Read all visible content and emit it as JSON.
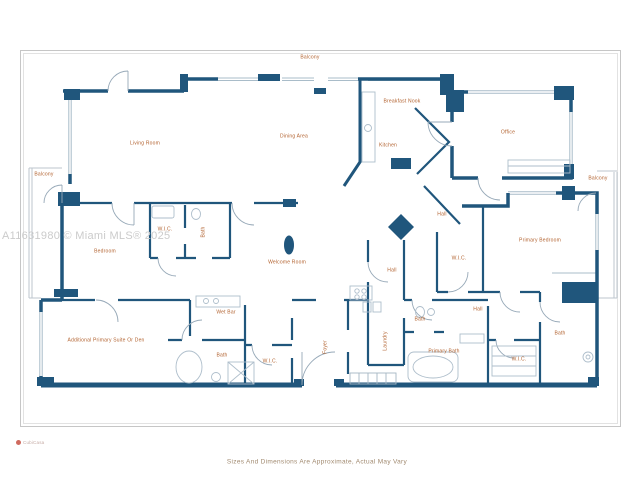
{
  "floor_plan": {
    "rooms": {
      "balcony_top": "Balcony",
      "balcony_left": "Balcony",
      "balcony_right": "Balcony",
      "living_room": "Living Room",
      "dining_area": "Dining Area",
      "breakfast_nook": "Breakfast Nook",
      "kitchen": "Kitchen",
      "office": "Office",
      "hall_upper": "Hall",
      "hall_lower": "Hall",
      "hall_entry": "Hall",
      "bedroom": "Bedroom",
      "wic_bedroom": "W.I.C.",
      "bath_bedroom": "Bath",
      "welcome_room": "Welcome Room",
      "primary_bedroom": "Primary Bedroom",
      "wic_primary": "W.I.C.",
      "additional_primary_suite": "Additional Primary Suite Or Den",
      "wet_bar": "Wet Bar",
      "bath_center": "Bath",
      "wic_center": "W.I.C.",
      "foyer": "Foyer",
      "laundry": "Laundry",
      "bath_small": "Bath",
      "primary_bath": "Primary Bath",
      "wic_right": "W.I.C.",
      "bath_right": "Bath"
    },
    "watermark": "A11631980 © Miami MLS® 2025",
    "disclaimer": "Sizes And Dimensions Are Approximate, Actual May Vary",
    "provider_logo_text": "CubiCasa",
    "colors": {
      "wall": "#20567c",
      "label": "#b2622f",
      "watermark": "#cbcbcb",
      "logo_dot": "#cf6a5e"
    }
  }
}
